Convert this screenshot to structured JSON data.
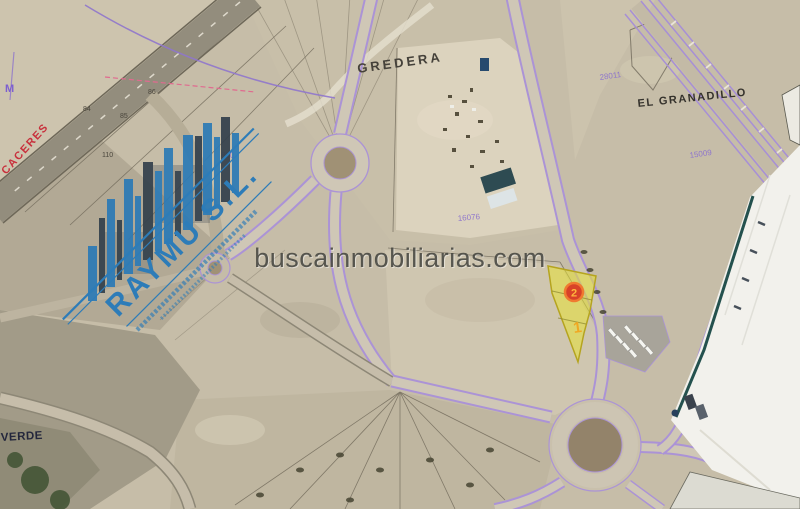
{
  "map": {
    "kind": "aerial-cadastral-map",
    "watermark": "buscainmobiliarias.com",
    "logo": {
      "company": "RAYMU S.L."
    },
    "labels": {
      "gredera": "GREDERA",
      "el_granadillo": "EL GRANADILLO",
      "caceres": "CACERES",
      "verde": "VERDE"
    },
    "parcel_numbers": {
      "yard_parcel": "16076",
      "north_parcel": "28011",
      "corridor_parcel": "15009",
      "west_parcel": "800",
      "n86": "86",
      "n85": "85",
      "n84": "84",
      "n110": "110",
      "left_symbol": "M"
    },
    "markers": {
      "primary": "2",
      "secondary": "1"
    },
    "colors": {
      "highlight_parcel": "#e8e135",
      "marker_primary_red": "#d84228",
      "marker_glyph_orange": "#ffb73d",
      "logo_blue": "#2d7cb8",
      "road_edge_purple": "#ab93d6",
      "caceres_red": "#c8303c",
      "watermark_gray": "#45453f"
    }
  }
}
